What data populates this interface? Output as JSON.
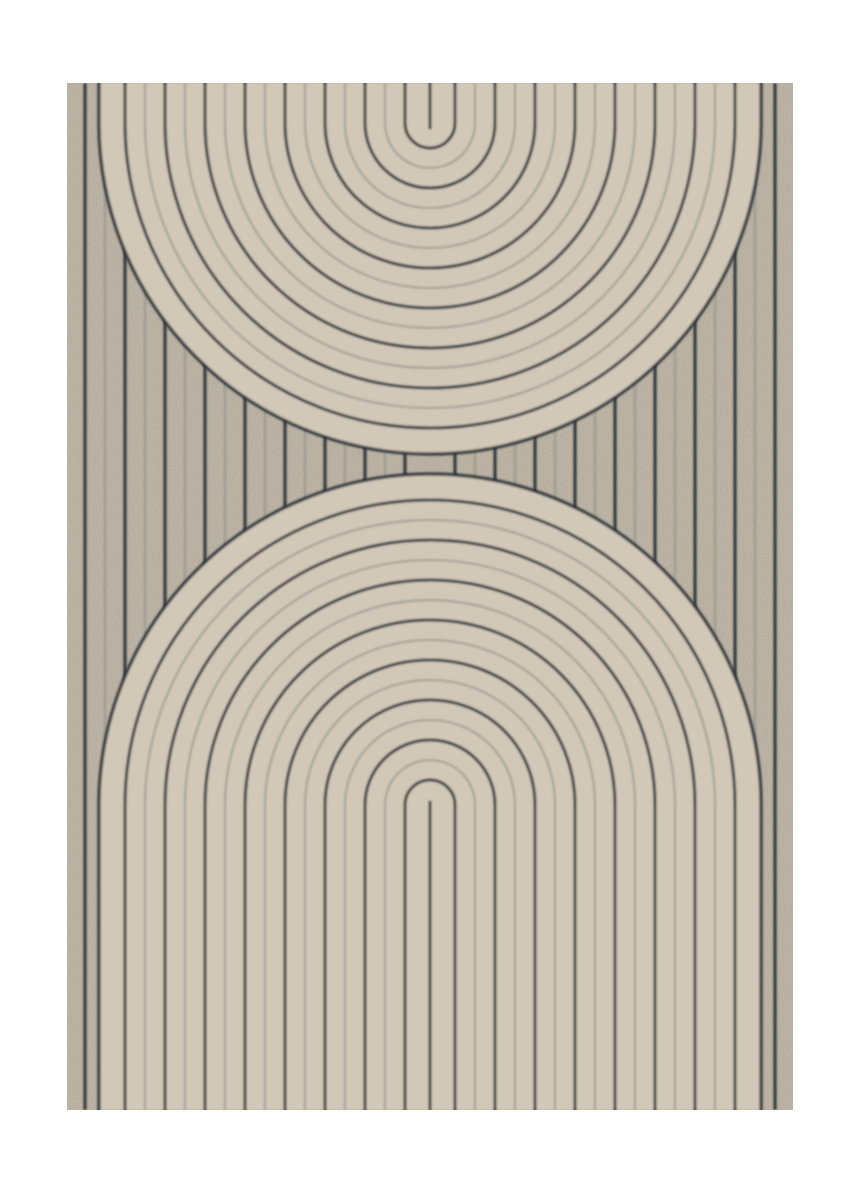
{
  "artwork": {
    "description_label": "abstract-arch-line-art-poster",
    "image": {
      "width": 867,
      "height": 1200,
      "margin_color": "#ffffff"
    },
    "panel": {
      "x": 67,
      "y": 83,
      "width": 726,
      "height": 1027,
      "fill": "#d1c8b7"
    },
    "palette": {
      "dark_line": "#242b34",
      "light_line": "#8e9089",
      "boundary_line": "#242b34",
      "grain_alpha": 0.16
    },
    "pattern": {
      "center_x": 430,
      "top_arch": {
        "center_y": 123,
        "legs_to": 83,
        "center_line": {
          "from": 83,
          "to": 128
        }
      },
      "bottom_arch": {
        "center_y": 805,
        "legs_to": 1110,
        "center_line": {
          "from": 802,
          "to": 1110
        }
      },
      "inner_radius": 25,
      "pitch": 20,
      "max_line_radius": 305,
      "boundary_radius": 331,
      "stripes_per_side": 17,
      "dark_stroke": 3,
      "light_stroke": 1.8,
      "boundary_stroke": 3.2,
      "dark_opacity": 0.95,
      "light_opacity": 0.82,
      "blur": 1
    }
  }
}
